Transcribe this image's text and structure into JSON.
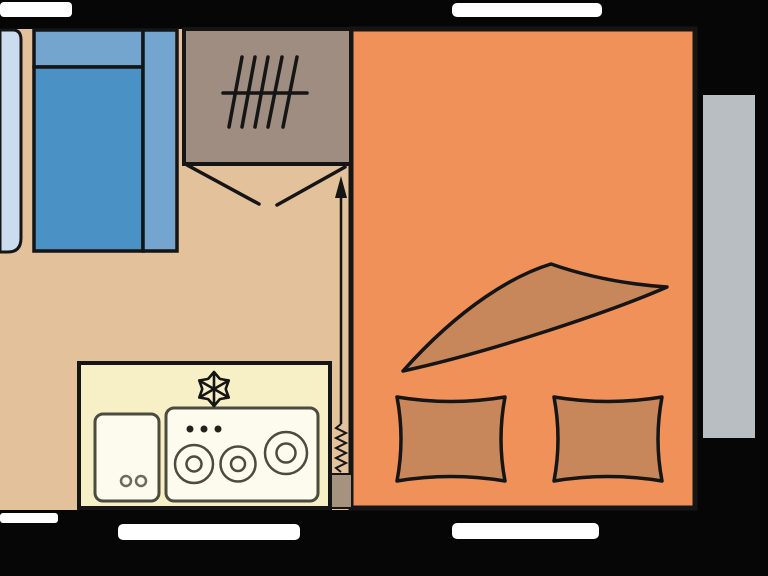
{
  "colors": {
    "wall_black": "#060606",
    "window_white": "#ffffff",
    "floor_beige": "#e3c19b",
    "bedroom_orange": "#f0915a",
    "bedding_brown": "#c8875b",
    "wardrobe_taupe": "#9e8d80",
    "heater_taupe": "#a5937f",
    "counter_cream": "#f7efc6",
    "fixture_white": "#fdfbee",
    "fixture_stroke": "#4b4b40",
    "knob_black": "#22221d",
    "seat_blue": "#4a92c5",
    "seat_light_blue": "#73a5ce",
    "table_pale_blue": "#cbdcef",
    "door_gray": "#b9bec3",
    "line_black": "#151515"
  },
  "fixtures": {
    "wardrobe_hatch_lines": 5,
    "stove_burners": 3,
    "stove_knobs": 3,
    "sink_holes": 2,
    "pillows": 2,
    "wall_windows": 5
  },
  "symbols": {
    "fridge": "snowflake-icon",
    "heater": "coil-zigzag-icon",
    "airflow": "up-arrow-icon",
    "wardrobe": "hanging-rail-hatch-icon",
    "entrance": "door-swing-lines"
  }
}
